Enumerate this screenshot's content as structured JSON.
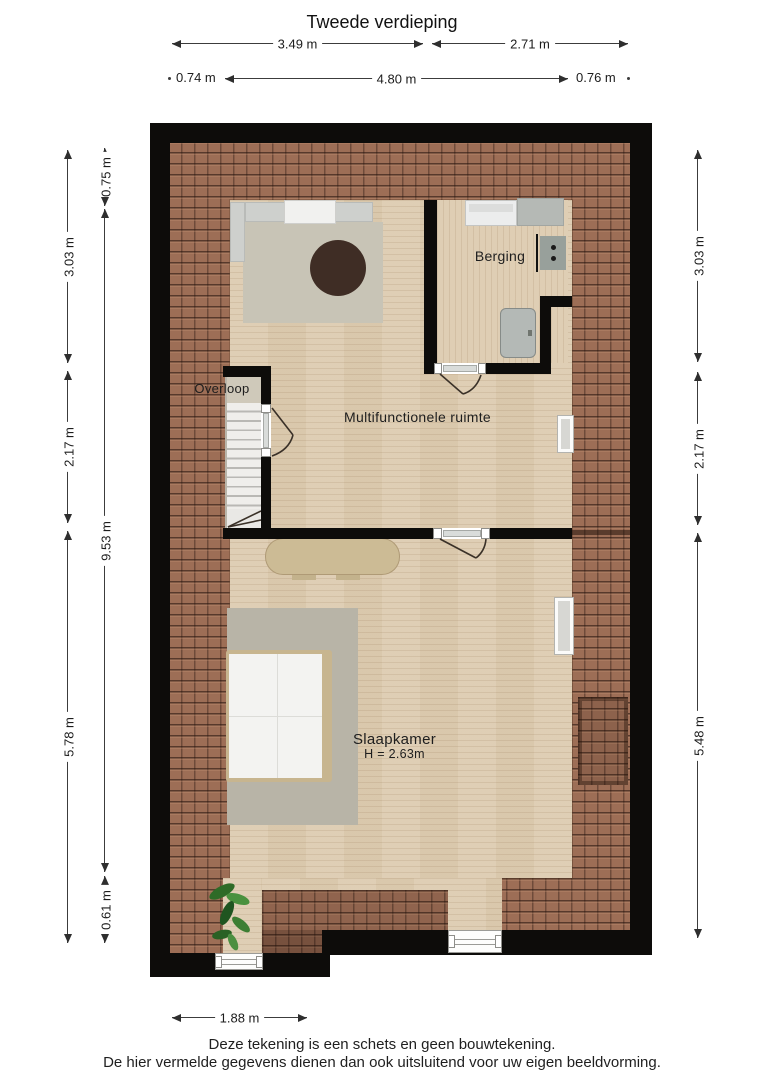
{
  "title": "Tweede verdieping",
  "rooms": {
    "berging": {
      "label": "Berging"
    },
    "overloop": {
      "label": "Overloop"
    },
    "multifunctionele_ruimte": {
      "label": "Multifunctionele ruimte"
    },
    "slaapkamer": {
      "label": "Slaapkamer",
      "ceiling_height": "H = 2.63m"
    }
  },
  "dimensions": {
    "top_row1": [
      {
        "label": "3.49 m"
      },
      {
        "label": "2.71 m"
      }
    ],
    "top_row2": [
      {
        "label": "0.74 m"
      },
      {
        "label": "4.80 m"
      },
      {
        "label": "0.76 m"
      }
    ],
    "left_outer": [
      {
        "label": "3.03 m"
      },
      {
        "label": "2.17 m"
      },
      {
        "label": "5.78 m"
      }
    ],
    "left_inner": [
      {
        "label": "0.75 m"
      },
      {
        "label": "9.53 m"
      },
      {
        "label": "0.61 m"
      }
    ],
    "right": [
      {
        "label": "3.03 m"
      },
      {
        "label": "2.17 m"
      },
      {
        "label": "5.48 m"
      }
    ],
    "bottom": [
      {
        "label": "1.88 m"
      }
    ]
  },
  "footer": {
    "line1": "Deze tekening is een schets en geen bouwtekening.",
    "line2": "De hier vermelde gegevens dienen dan ook uitsluitend voor uw eigen beeldvorming."
  },
  "colors": {
    "wall": "#0d0c0a",
    "roof_tiles": "#9d6e56",
    "floor": "#ddccb1",
    "rug": "#b8b4a7",
    "text": "#1a1a1a"
  }
}
